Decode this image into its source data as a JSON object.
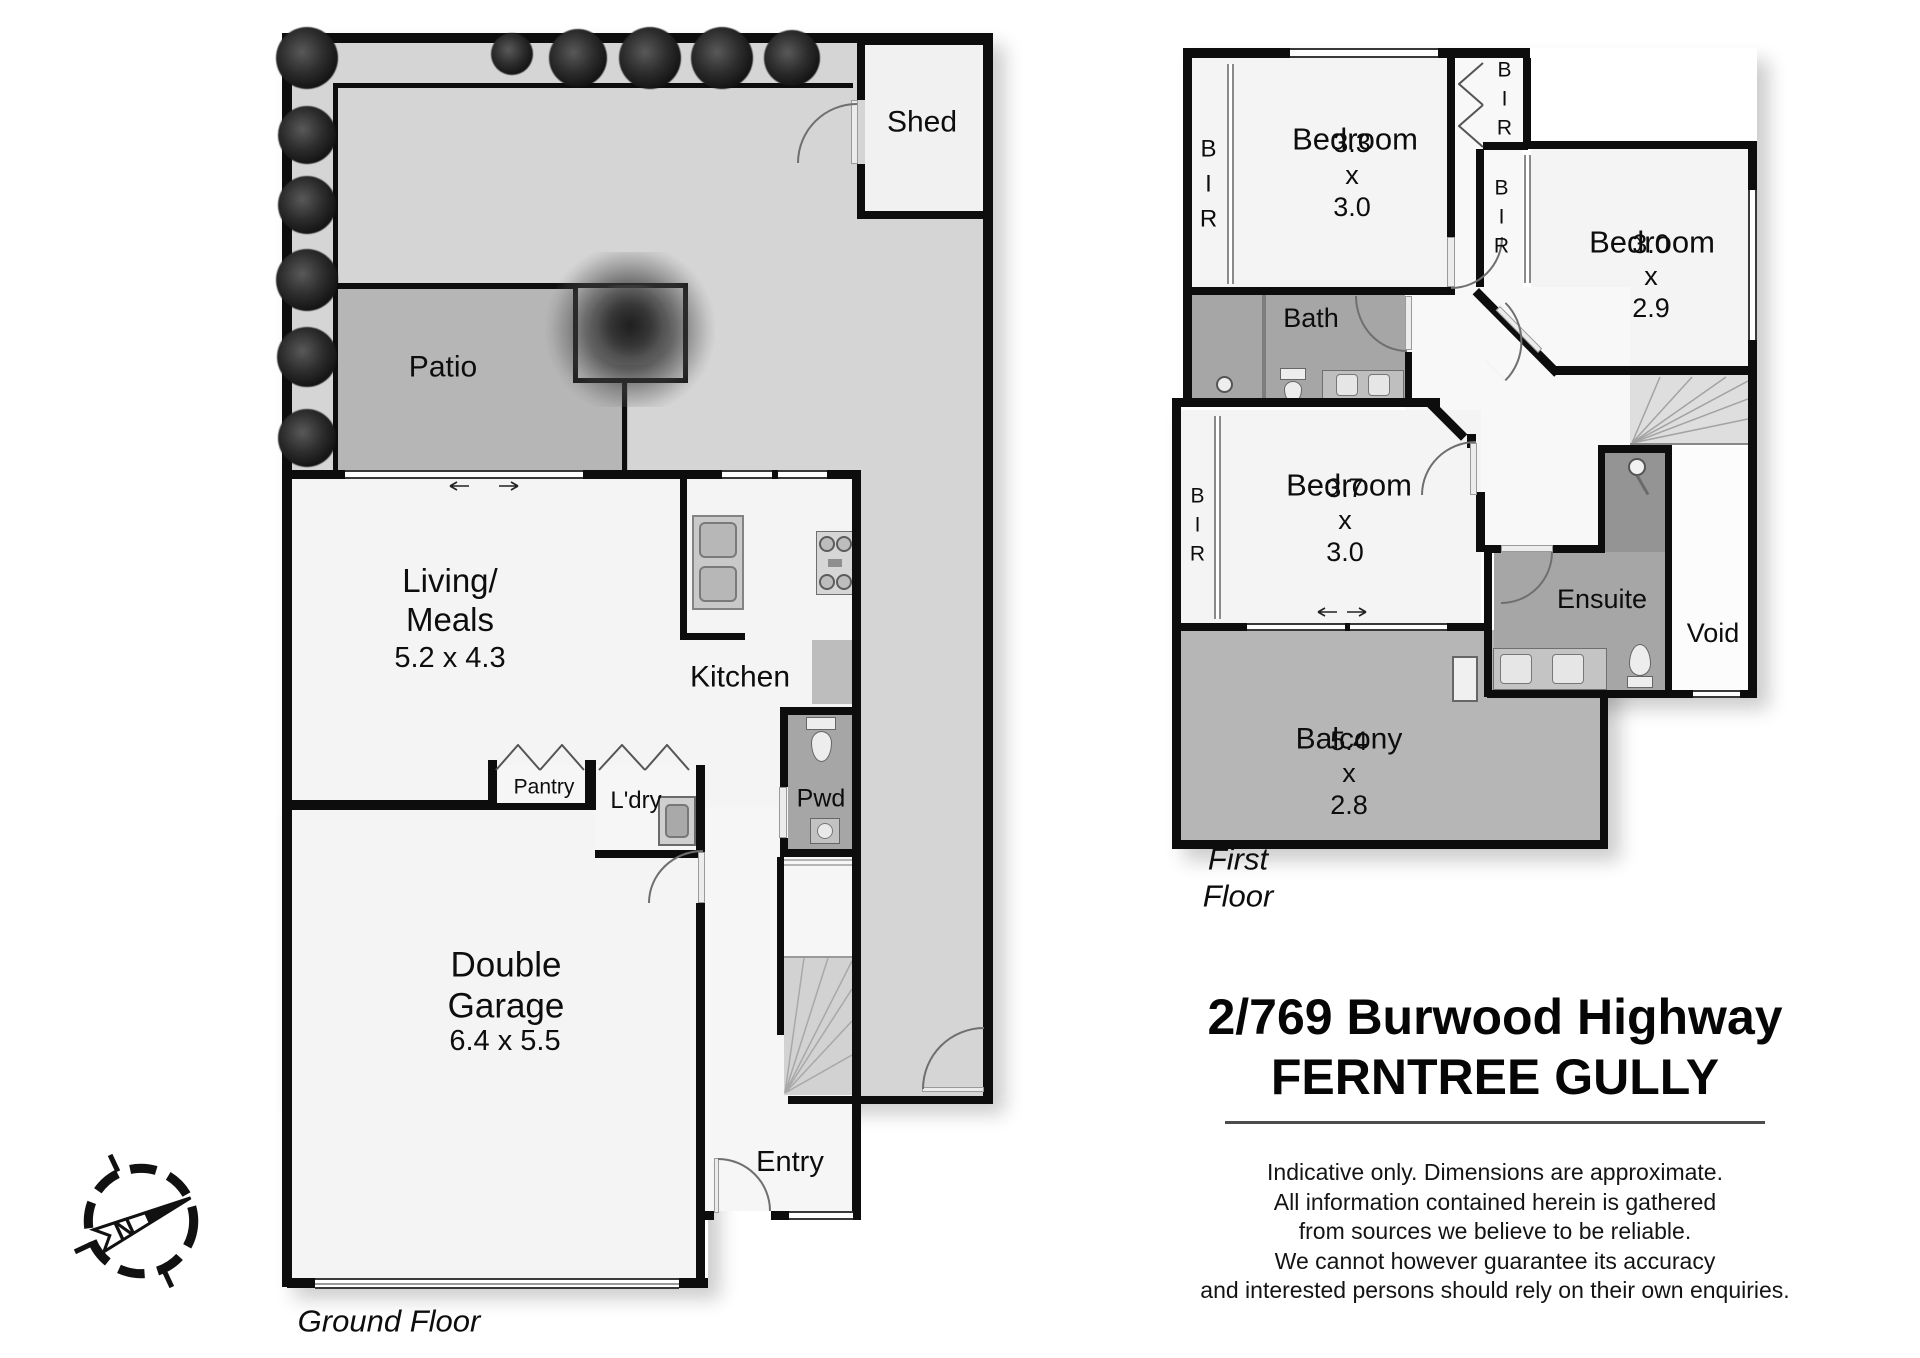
{
  "title": {
    "line1": "2/769 Burwood Highway",
    "line2": "FERNTREE GULLY"
  },
  "disclaimer": {
    "text": "Indicative only. Dimensions are approximate.\nAll information contained herein is gathered\nfrom sources we believe to be reliable.\nWe cannot however guarantee its accuracy\nand interested persons should rely on their own enquiries."
  },
  "compass": {
    "north": "N"
  },
  "ground_floor": {
    "caption": "Ground Floor",
    "rooms": {
      "shed": {
        "name": "Shed"
      },
      "patio": {
        "name": "Patio"
      },
      "living_meals": {
        "name": "Living/\nMeals",
        "dims": "5.2 x 4.3"
      },
      "kitchen": {
        "name": "Kitchen"
      },
      "pantry": {
        "name": "Pantry"
      },
      "laundry": {
        "name": "L'dry"
      },
      "powder": {
        "name": "Pwd"
      },
      "garage": {
        "name": "Double\nGarage",
        "dims": "6.4 x 5.5"
      },
      "entry": {
        "name": "Entry"
      }
    }
  },
  "first_floor": {
    "caption": "First Floor",
    "rooms": {
      "bedroom1": {
        "name": "Bedroom",
        "dims": "3.3 x 3.0"
      },
      "bedroom2": {
        "name": "Bedroom",
        "dims": "3.0 x 2.9"
      },
      "bedroom3": {
        "name": "Bedroom",
        "dims": "3.7 x 3.0"
      },
      "bath": {
        "name": "Bath"
      },
      "ensuite": {
        "name": "Ensuite"
      },
      "void": {
        "name": "Void"
      },
      "balcony": {
        "name": "Balcony",
        "dims": "5.4 x 2.8"
      },
      "bir1": {
        "name": "BIR"
      },
      "bir2": {
        "name": "BIR"
      },
      "bir3": {
        "name": "BIR"
      },
      "bir4": {
        "name": "BIR"
      }
    }
  },
  "colors": {
    "wall": "#0d0d0d",
    "garden": "#d5d5d5",
    "patio_balcony": "#b6b6b6",
    "wet_room": "#a6a6a6",
    "shower": "#949494",
    "interior": "#f4f4f4"
  }
}
